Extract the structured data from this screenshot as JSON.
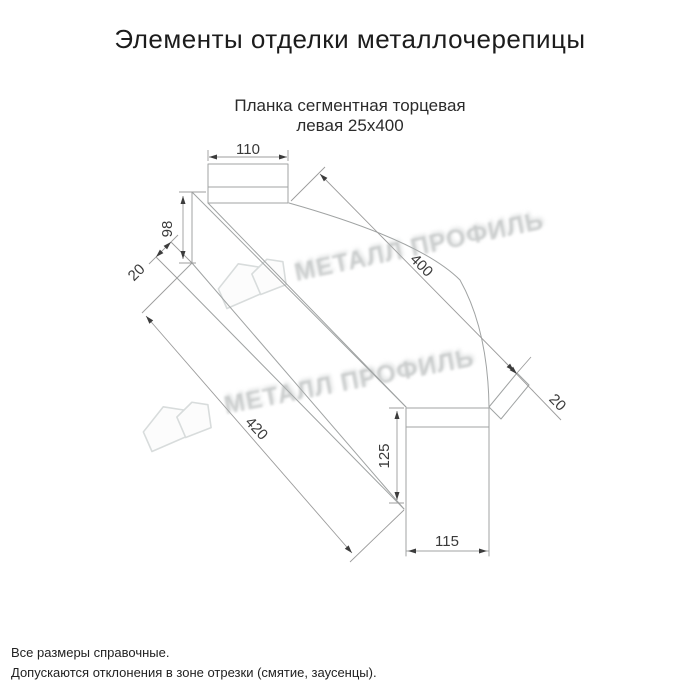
{
  "header": {
    "title": "Элементы отделки металлочерепицы"
  },
  "product": {
    "name_line1": "Планка сегментная торцевая",
    "name_line2": "левая 25х400"
  },
  "dimensions": {
    "top_flange_width_mm": "110",
    "left_end_height_mm": "98",
    "left_hem_mm": "20",
    "top_length_mm": "400",
    "right_hem_mm": "20",
    "bottom_length_mm": "420",
    "right_end_height_mm": "125",
    "bottom_flange_width_mm": "115"
  },
  "watermark": {
    "brand_text": "МЕТАЛЛ ПРОФИЛЬ",
    "logo": "metal-profile-house-logo"
  },
  "notes": {
    "line1": "Все размеры справочные.",
    "line2": "Допускаются отклонения в зоне отрезки (смятие, заусенцы)."
  },
  "colors": {
    "background": "#ffffff",
    "drawing_line": "#a0a3a3",
    "dimension_line": "#9c9c9c",
    "dimension_text": "#3a3a3a",
    "title_text": "#1c1c1c",
    "watermark_text": "#b9bdbd"
  }
}
